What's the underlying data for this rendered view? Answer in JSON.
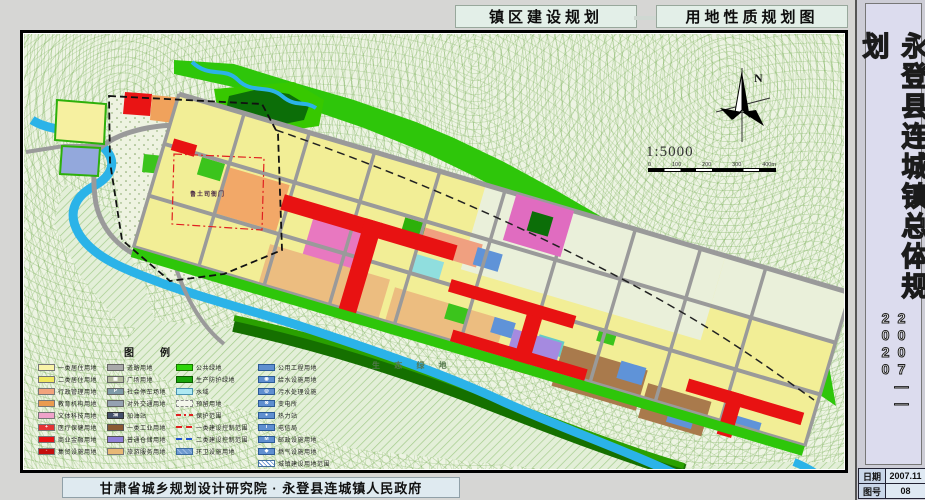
{
  "header": {
    "left_tab": "镇区建设规划",
    "right_tab": "用地性质规划图"
  },
  "sidebar": {
    "title": "永登县连城镇总体规划",
    "years": "2007——2020",
    "rows": [
      {
        "label": "日期",
        "value": "2007.11"
      },
      {
        "label": "图号",
        "value": "08"
      }
    ]
  },
  "footer": {
    "credit": "甘肃省城乡规划设计研究院 · 永登县连城镇人民政府"
  },
  "map": {
    "north": "N",
    "scale_ratio": "1:5000",
    "scale_ticks": [
      "0",
      "100",
      "200",
      "300",
      "400m"
    ],
    "labels": {
      "heritage": "鲁土司衙门",
      "eco": "生 态 绿 地"
    }
  },
  "palette": {
    "residential_yellow": "#f2ee96",
    "commercial_red": "#e81212",
    "public_green": "#2ec60a",
    "water_blue": "#2bb3e8",
    "road_gray": "#9a9a9a",
    "industry_brown": "#a97a4c",
    "warehouse_purple": "#a58ae0",
    "heritage_pink": "#c981b8"
  },
  "legend": {
    "title": "图　　例",
    "col1": [
      {
        "label": "一类居住用地",
        "sw": "background:#f8f3a8;border:1px solid #777"
      },
      {
        "label": "二类居住用地",
        "sw": "background:#f1e85e;border:1px solid #777"
      },
      {
        "label": "行政管理用地",
        "sw": "background:#f2a37c;border:1px solid #777"
      },
      {
        "label": "教育机构用地",
        "sw": "background:#ea9b50;border:1px solid #777"
      },
      {
        "label": "文体科技用地",
        "sw": "background:#f0a2ca;border:1px solid #777"
      },
      {
        "label": "医疗保健用地",
        "sw": "background:#e43434;border:1px solid #777",
        "mark": "+"
      },
      {
        "label": "商业金融用地",
        "sw": "background:#e81113;border:1px solid #777"
      },
      {
        "label": "集贸设施用地",
        "sw": "background:#c50d0d;border:1px solid #777",
        "mark": "◦"
      }
    ],
    "col2": [
      {
        "label": "道路用地",
        "sw": "background:#a9a9a9;border:1px solid #666"
      },
      {
        "label": "广场用地",
        "sw": "background:#b5bda0;border:1px solid #666",
        "mark": "▦"
      },
      {
        "label": "社会停车场地",
        "sw": "background:#7f9ba8;border:1px solid #666",
        "mark": "P"
      },
      {
        "label": "对外交通用地",
        "sw": "background:#95a2b2;border:1px solid #666"
      },
      {
        "label": "加油站",
        "sw": "background:#44506b;border:1px solid #333",
        "mark": "油"
      },
      {
        "label": "一类工业用地",
        "sw": "background:#8a5a33;border:1px solid #555"
      },
      {
        "label": "普通仓储用地",
        "sw": "background:#8f7fd8;border:1px solid #555"
      },
      {
        "label": "旅游服务用地",
        "sw": "background:#e7b876;border:1px solid #777"
      }
    ],
    "col3": [
      {
        "label": "公共绿地",
        "sw": "background:#2fd40a;border:1px solid #177700"
      },
      {
        "label": "生产防护绿地",
        "sw": "background:#18a50a;border:1px solid #0c5c00"
      },
      {
        "label": "水域",
        "sw": "background:#aee9f2;border:1px solid #4a93b0"
      },
      {
        "label": "预留用地",
        "sw": "background:#f4f7ec;border:1px dashed #888"
      },
      {
        "label": "保护范围",
        "sw": "height:2px;border:none;background:repeating-linear-gradient(90deg,#e02020 0 5px,transparent 5px 8px,#e02020 8px 10px,transparent 10px 13px)"
      },
      {
        "label": "一类建设控制范围",
        "sw": "height:2px;border:none;background:repeating-linear-gradient(90deg,#e02020 0 6px,transparent 6px 10px)"
      },
      {
        "label": "二类建设控制范围",
        "sw": "height:2px;border:none;background:repeating-linear-gradient(90deg,#2255cc 0 6px,transparent 6px 10px)"
      },
      {
        "label": "环卫设施用地",
        "sw": "background:repeating-linear-gradient(45deg,#6f9ad0 0 3px,#9cbbe4 3px 4px);border:1px solid #3a6aa0"
      }
    ],
    "col4": [
      {
        "label": "公用工程用地",
        "sw": "background:#5f8fd0;border:1px solid #2c5a96"
      },
      {
        "label": "给水设施用地",
        "sw": "background:#5f8fd0;border:1px solid #2c5a96",
        "mark": "◉"
      },
      {
        "label": "污水处理设施",
        "sw": "background:#5f8fd0;border:1px solid #2c5a96",
        "mark": "◎"
      },
      {
        "label": "变电所",
        "sw": "background:#5f8fd0;border:1px solid #2c5a96",
        "mark": "⊗"
      },
      {
        "label": "热力站",
        "sw": "background:#5f8fd0;border:1px solid #2c5a96",
        "mark": "●"
      },
      {
        "label": "电信局",
        "sw": "background:#5f8fd0;border:1px solid #2c5a96",
        "mark": "T"
      },
      {
        "label": "邮政设施用地",
        "sw": "background:#5f8fd0;border:1px solid #2c5a96",
        "mark": "M"
      },
      {
        "label": "燃气设施用地",
        "sw": "background:#5f8fd0;border:1px solid #2c5a96",
        "mark": "◆"
      },
      {
        "label": "城镇建设用地范围",
        "sw": "background:repeating-linear-gradient(45deg,#fff 0 2px,#5f8fd0 2px 3px);border:1px solid #44709c"
      }
    ]
  }
}
